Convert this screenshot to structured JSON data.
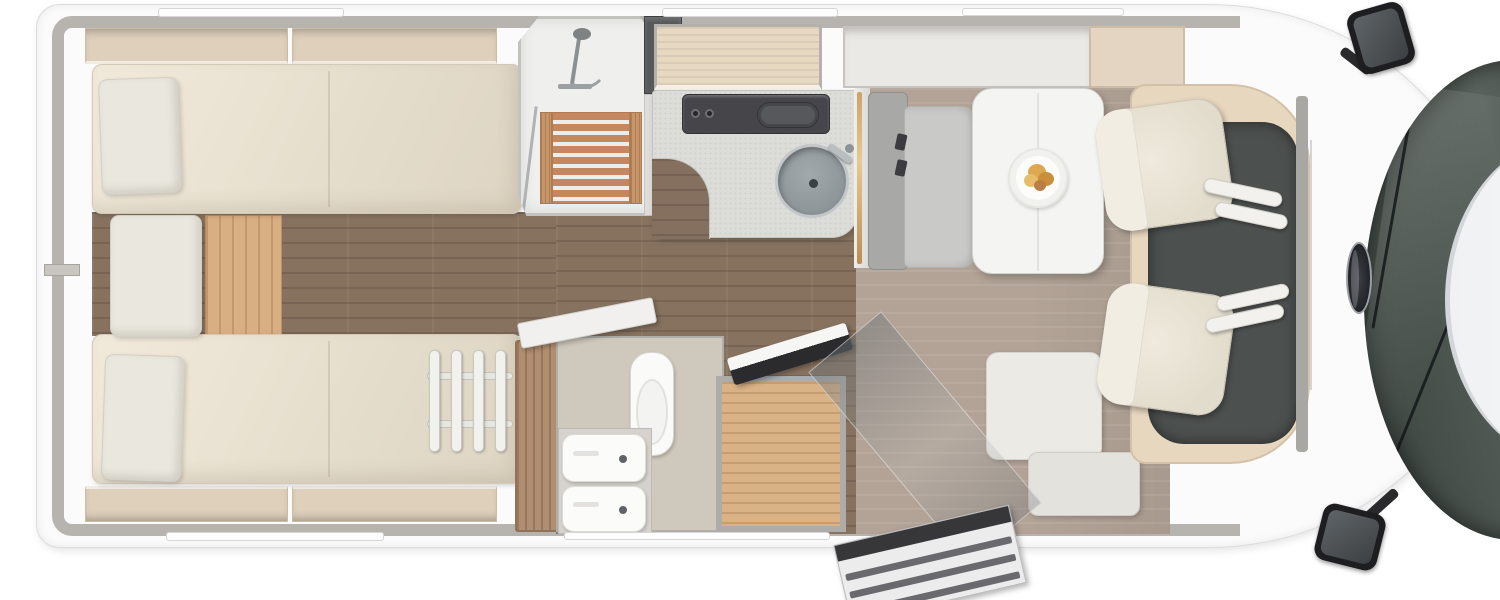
{
  "scene": {
    "type": "motorhome-floorplan-top-view",
    "regions": {
      "bedroom": {
        "label": "Rear bedroom with twin single beds"
      },
      "shower": {
        "label": "Shower cabin with wooden grate"
      },
      "kitchen": {
        "label": "Kitchenette with hob and round sink"
      },
      "bathroom": {
        "label": "Washroom with toilet and washbasin"
      },
      "wardrobe": {
        "label": "Wardrobe"
      },
      "dinette": {
        "label": "Dinette with table and bench"
      },
      "entry": {
        "label": "Entrance door with exterior step"
      },
      "cab": {
        "label": "Driver cab with two swivel seats"
      },
      "front": {
        "label": "Windscreen, bonnet and mirrors"
      }
    },
    "palette": {
      "body_white": "#fbfbfc",
      "wall_gray": "#b7b4b0",
      "locker_beige": "#dfd0bc",
      "mattress_cream": "#ece4d4",
      "dark_floor": "#87725f",
      "light_floor": "#b2a396",
      "step_oak": "#d8ae83",
      "shower_slat": "#c5875f",
      "counter_gray": "#dcdcd8",
      "stove_dark": "#46464a",
      "seat_cream": "#e9e4d7",
      "cab_mat": "#4c504f",
      "windshield": "#39413d",
      "accent_brass": "#caa36a"
    }
  }
}
